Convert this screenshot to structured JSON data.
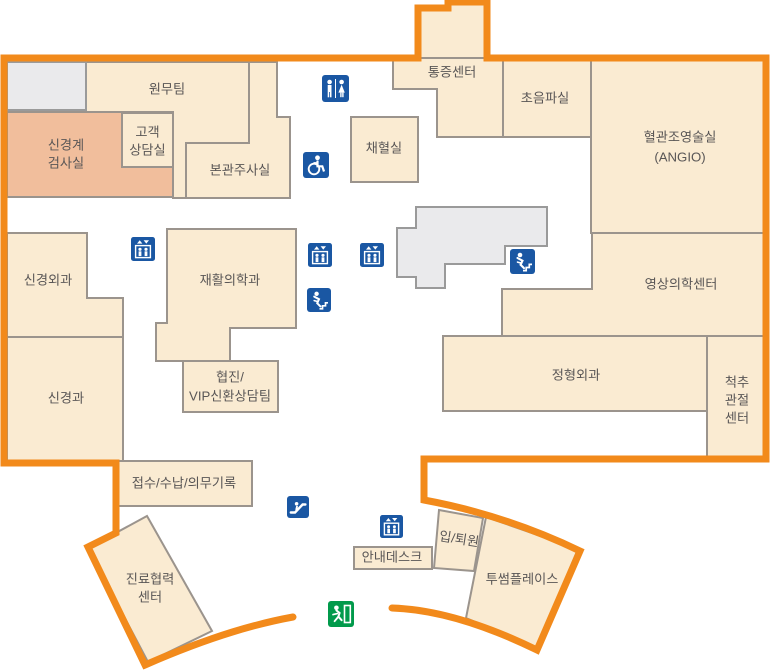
{
  "title": "hospital-floor-map",
  "colors": {
    "outline_orange": "#F28A1B",
    "room_beige": "#FAEBD2",
    "room_highlight_salmon": "#F1BE9C",
    "room_gray": "#EAEAEC",
    "wall_gray": "#9B948D",
    "icon_blue": "#1A57A3",
    "icon_green": "#019A4B",
    "label_text": "#595656"
  },
  "rooms": {
    "wonmu": {
      "label": "원무팀"
    },
    "gogaek": {
      "label1": "고객",
      "label2": "상담실"
    },
    "singyeonggye": {
      "label1": "신경계",
      "label2": "검사실"
    },
    "bongwan": {
      "label": "본관주사실"
    },
    "chaehyeol": {
      "label": "채혈실"
    },
    "tongjeung": {
      "label": "통증센터"
    },
    "choeumpa": {
      "label": "초음파실"
    },
    "angio": {
      "label1": "혈관조영술실",
      "label2": "(ANGIO)"
    },
    "singyeongoegwa": {
      "label": "신경외과"
    },
    "jaehwal": {
      "label": "재활의학과"
    },
    "singyeonggwa": {
      "label": "신경과"
    },
    "hyeopjin": {
      "label1": "협진/",
      "label2": "VIP신환상담팀"
    },
    "yeongsang": {
      "label": "영상의학센터"
    },
    "jeonghyeong": {
      "label": "정형외과"
    },
    "cheokchu": {
      "label1": "척추",
      "label2": "관절",
      "label3": "센터"
    },
    "jeopsu": {
      "label": "접수/수납/의무기록"
    },
    "jinryo": {
      "label1": "진료협력",
      "label2": "센터"
    },
    "annae": {
      "label": "안내데스크"
    },
    "iptoewon": {
      "label": "입/퇴원"
    },
    "twosome": {
      "label": "투썸플레이스"
    }
  },
  "icons": {
    "restroom": "restroom-icon",
    "wheelchair": "wheelchair-accessible-icon",
    "elevator": "elevator-icon",
    "stairs": "stairs-icon",
    "escalator": "escalator-icon",
    "exit": "emergency-exit-icon"
  }
}
